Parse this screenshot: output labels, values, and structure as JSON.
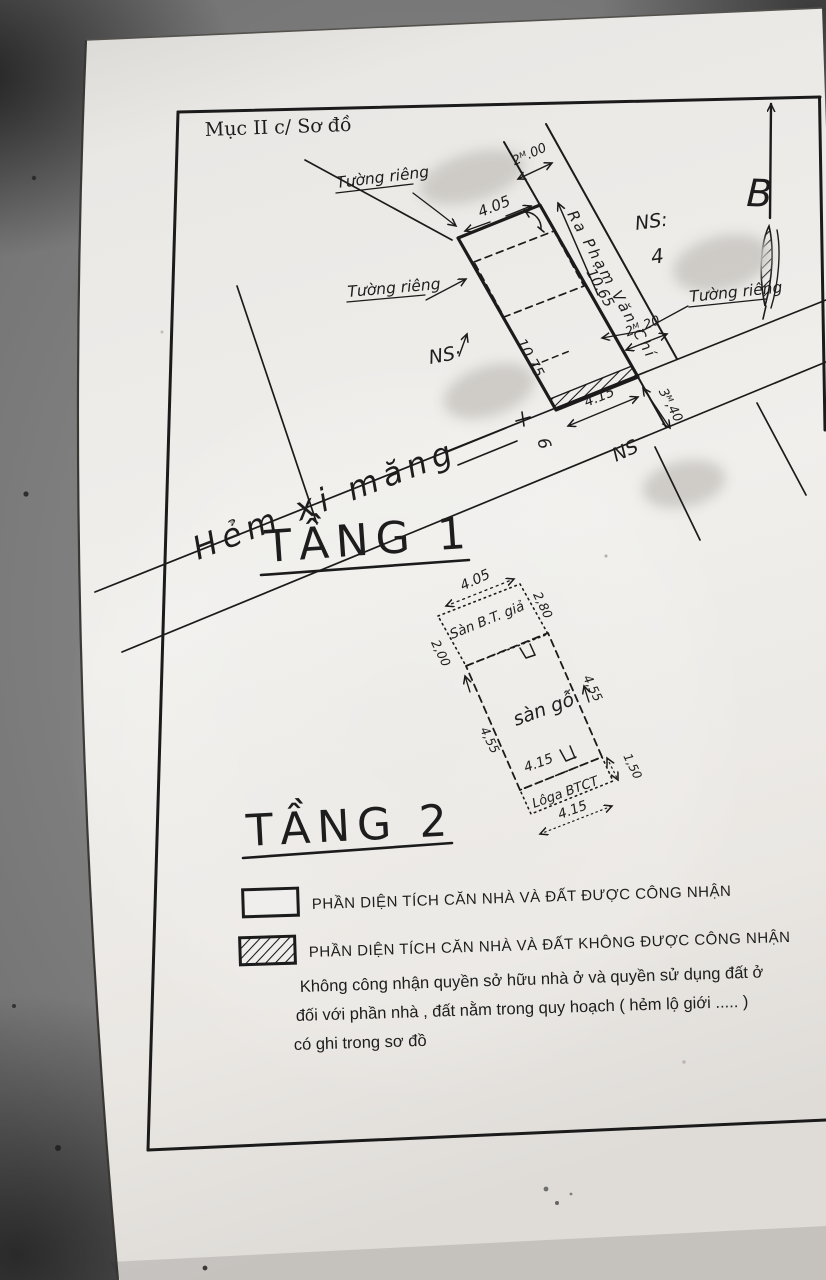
{
  "paper": {
    "section_title": "Mục II c/ Sơ đồ",
    "north_label": "B"
  },
  "floor1": {
    "heading": "TẦNG 1",
    "wall_label_top": "Tường riêng",
    "wall_label_left": "Tường riêng",
    "wall_label_right": "Tường riêng",
    "road_label": "Ra Phạm Văn Chí",
    "alley_label": "Hẻm xi măng",
    "marker_number": "6",
    "ns_top": "NS:",
    "ns_top_value": "4",
    "ns_left": "NS·",
    "ns_bottom": "NS",
    "dim_top_width": "4.05",
    "dim_road_width_top": "2ᴹ.00",
    "dim_road_length": "10.65",
    "dim_wall_length": "10.75",
    "dim_road_width_bottom": "2ᴹ,20",
    "dim_alley_width": "3ᴹ,40",
    "dim_bottom_width": "4.15"
  },
  "floor2": {
    "heading": "TẦNG 2",
    "front_area_label": "Sàn B.T. giả",
    "main_area_label": "sàn gỗ",
    "balcony_label": "Lôga BTCT",
    "dim_front_width": "4.05",
    "dim_front_depth_left": "2,00",
    "dim_front_depth_right": "2,80",
    "dim_main_depth_left": "4,55",
    "dim_main_depth_right": "4,55",
    "dim_main_width": "4.15",
    "dim_balcony_depth": "1,50",
    "dim_balcony_width": "4.15"
  },
  "legend": {
    "recognized_label": "PHẦN DIỆN TÍCH CĂN NHÀ VÀ ĐẤT ĐƯỢC CÔNG NHẬN",
    "not_recognized_label": "PHẦN DIỆN TÍCH CĂN NHÀ VÀ ĐẤT KHÔNG ĐƯỢC CÔNG NHẬN",
    "note_line1": "Không công nhận quyền sở hữu nhà ở và quyền sử dụng đất ở",
    "note_line2": "đối với phần nhà , đất  nằm trong quy hoạch ( hẻm lộ giới ..... )",
    "note_line3": "có ghi trong sơ đồ"
  }
}
